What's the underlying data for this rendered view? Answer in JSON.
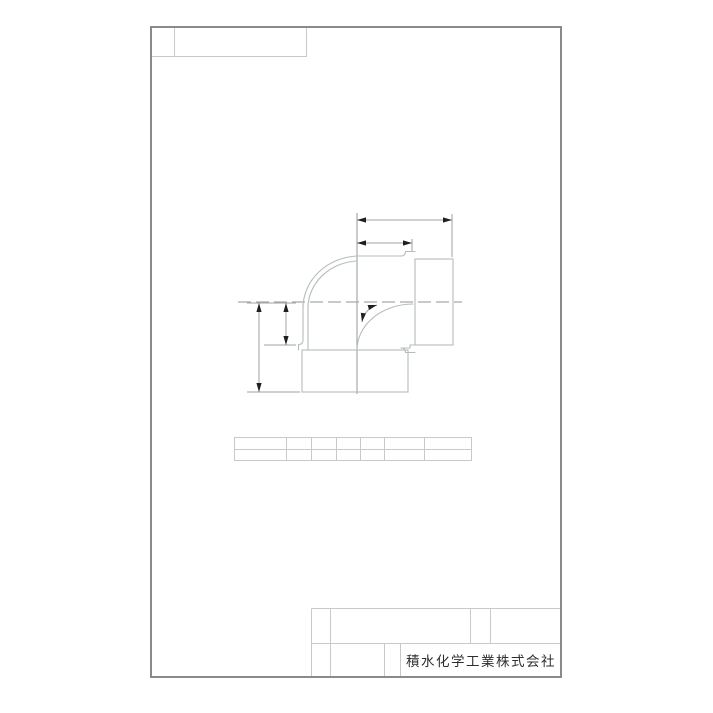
{
  "title_block": {
    "company": "積水化学工業株式会社"
  },
  "colors": {
    "background": "#ffffff",
    "frame": "#8a8a8a",
    "grid": "#c9c9c9",
    "drawing": "#b6bcbc",
    "centerline": "#a6aaaa",
    "dimension": "#9fa3a3",
    "arrow": "#1f1f1f",
    "text": "#2e2e2e"
  }
}
